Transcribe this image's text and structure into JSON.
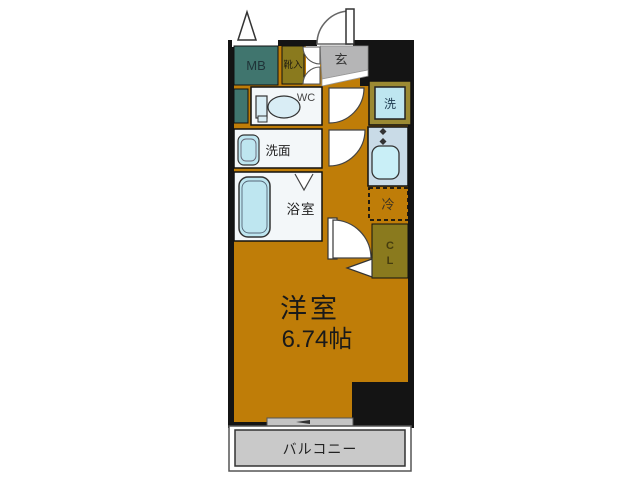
{
  "plan": {
    "room_name": "洋室",
    "room_size": "6.74帖",
    "balcony": "バルコニー",
    "entrance": "玄",
    "meter_box": "MB",
    "shoe_cabinet": "靴入",
    "toilet": "WC",
    "washroom": "洗面",
    "bathroom": "浴室",
    "washer": "洗",
    "fridge": "冷",
    "closet_line1": "C",
    "closet_line2": "L"
  },
  "colors": {
    "wall": "#141414",
    "room_orange": "#BF7D08",
    "olive": "#8A7A1E",
    "washer_frame": "#9B8A33",
    "teal": "#40756E",
    "genkan_gray": "#B5B5B6",
    "balcony_gray": "#C9C9C9",
    "fixture_blue": "#BEE6F0",
    "fixture_blue_light": "#D9EDF5",
    "kitchen_blue": "#C9DBE7",
    "sink_blue": "#C9EFF7",
    "room_white": "#F3F7F9",
    "window_gray": "#C4C4C4"
  }
}
